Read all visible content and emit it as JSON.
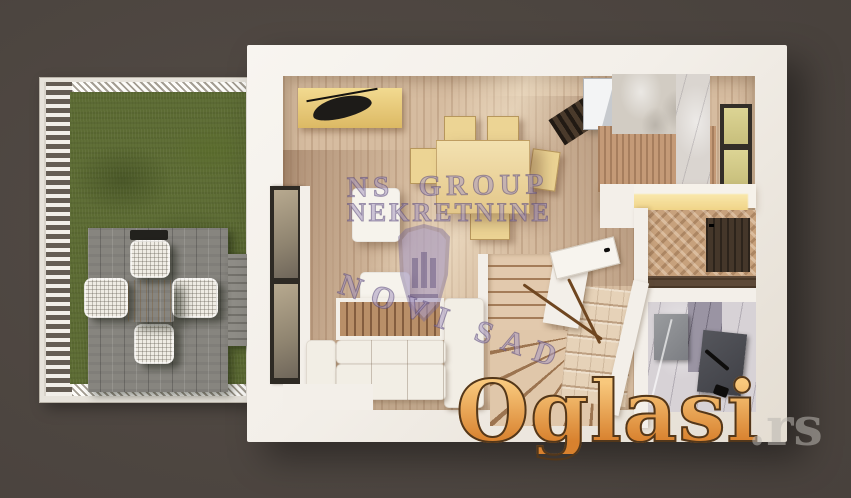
{
  "watermarks": {
    "agency_line1": "NS  GROUP",
    "agency_line2": "NEKRETNINE",
    "agency_line3": "NOVI SAD",
    "portal_name": "Oglasi",
    "portal_tld": ".rs"
  },
  "colors": {
    "background": "#4a433e",
    "grass": "#5c6b33",
    "deck": "#87857f",
    "wall": "#f3efe9",
    "floor_wood": "#d6bca0",
    "accent_wood": "#ecd494",
    "watermark_purple": "#a899c1",
    "oglasi_top": "#f8c87c",
    "oglasi_bottom": "#d8812e",
    "oglasi_outline": "#53371a",
    "rs_gray": "#bab6b0"
  }
}
